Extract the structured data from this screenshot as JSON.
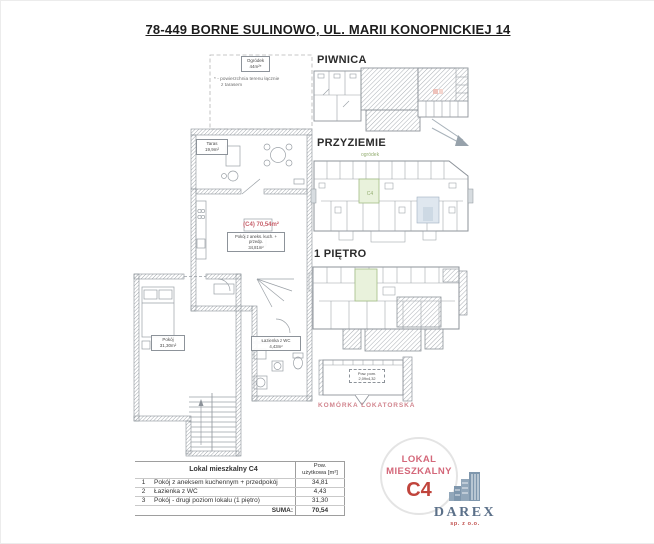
{
  "page": {
    "title": "78-449 BORNE SULINOWO, UL. MARII KONOPNICKIEJ 14"
  },
  "left_plan": {
    "garden_label": "Ogródek",
    "garden_area": "44m²*",
    "garden_note_line1": "* - powierzchnia terenu łącznie",
    "garden_note_line2": "z tarasem",
    "terrace_label": "Taras",
    "terrace_area": "19,9m²",
    "unit_area_label": "(C4) 70,54m²",
    "room1_label": "Pokój z aneks. kuch. + przedp.",
    "room1_area": "34,81m²",
    "room2_label": "Pokój",
    "room2_area": "31,30m²",
    "bath_label": "Łazienka z WC",
    "bath_area": "4,43m²"
  },
  "floors": {
    "basement_label": "PIWNICA",
    "ground_label": "PRZYZIEMIE",
    "first_label": "1 PIĘTRO",
    "ogrodek_text": "ogródek",
    "c4_cell": "C4",
    "storage_label": "KOMÓRKA LOKATORSKA",
    "storage_dim_line1": "Pow. pom.",
    "storage_dim_line2": "2,09x4,32"
  },
  "table": {
    "header_name": "Lokal mieszkalny C4",
    "header_area_line1": "Pow.",
    "header_area_line2": "użytkowa [m²]",
    "rows": [
      {
        "no": "1",
        "name": "Pokój z aneksem kuchennym + przedpokój",
        "area": "34,81"
      },
      {
        "no": "2",
        "name": "Łazienka z WC",
        "area": "4,43"
      },
      {
        "no": "3",
        "name": "Pokój - drugi poziom lokalu (1 piętro)",
        "area": "31,30"
      }
    ],
    "suma_label": "SUMA:",
    "suma_value": "70,54"
  },
  "badge": {
    "line1": "LOKAL",
    "line2": "MIESZKALNY",
    "unit": "C4"
  },
  "logo": {
    "name": "DAREX",
    "sub": "sp. z o.o."
  },
  "icons": {
    "north_arrow_icon": "thin arrow pointing south-east (svg shape)",
    "buildings_icon": "city buildings silhouette (svg shape)"
  },
  "colors": {
    "accent_red": "#c0443c",
    "badge_pink": "#d4687a",
    "highlight_green": "#e9f2dc",
    "corridor_blue": "#dfe7ef",
    "plan_line": "#8d939a",
    "storage_label_pink": "#d2868f",
    "logo_blue": "#7f97ad",
    "logo_text_blue": "#5b7089"
  }
}
